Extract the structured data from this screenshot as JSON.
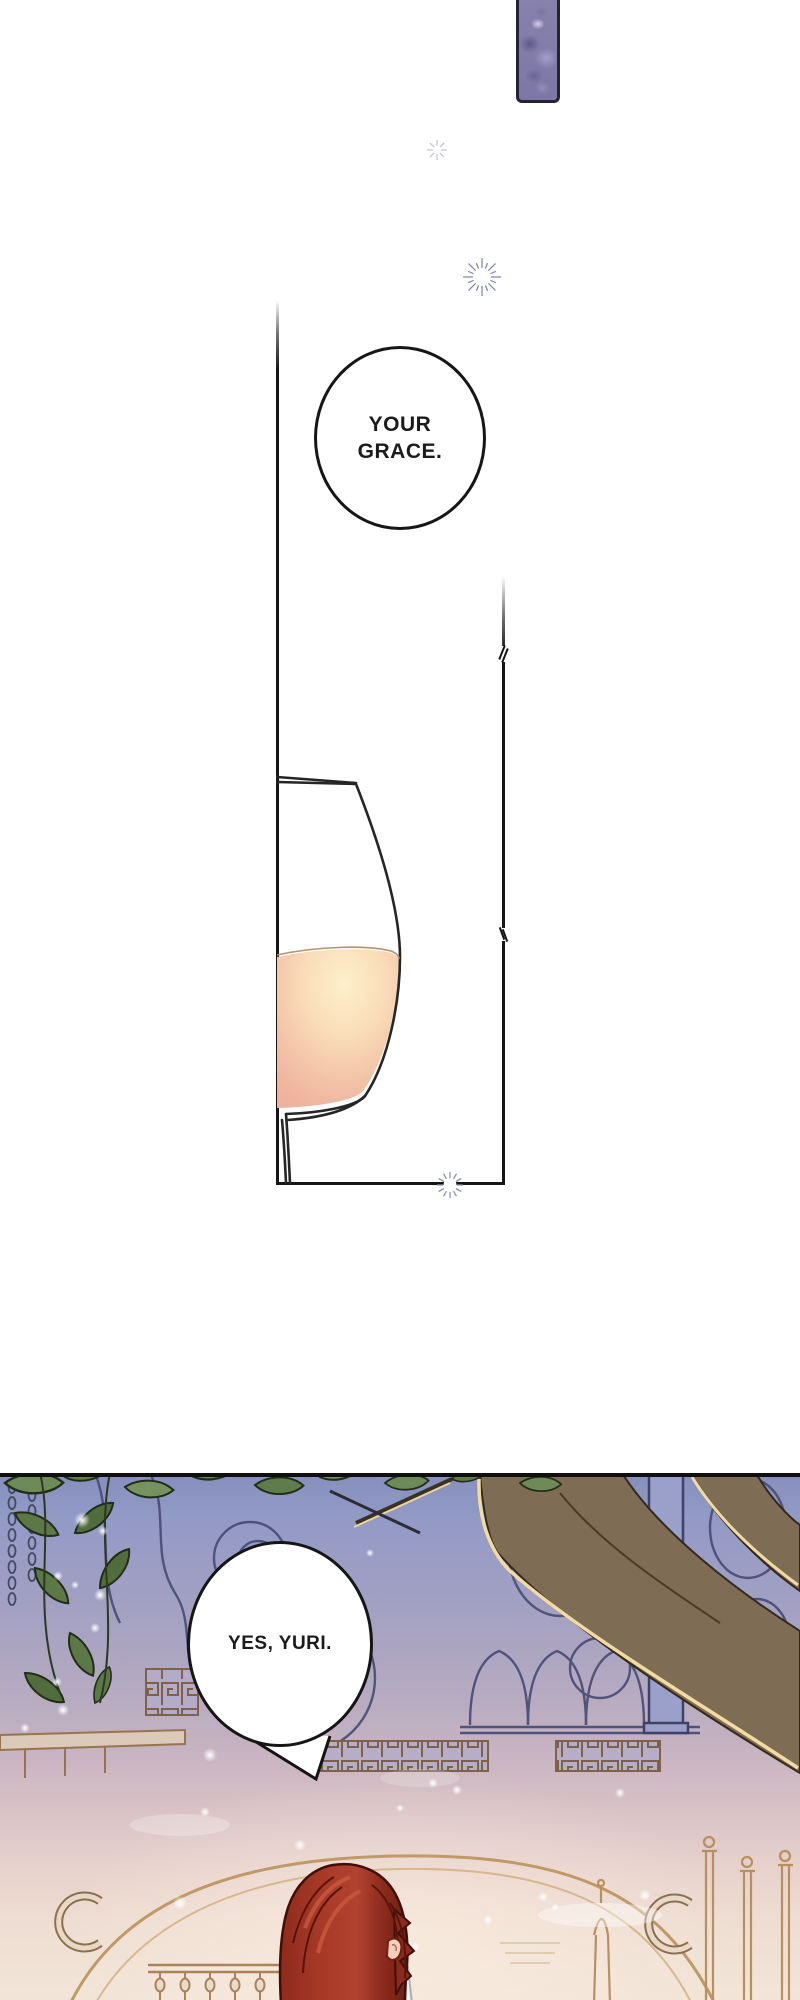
{
  "page": {
    "width_px": 800,
    "height_px": 2000,
    "background": "#ffffff",
    "kind": "webtoon comic page"
  },
  "dialogue": {
    "bubble1": "YOUR GRACE.",
    "bubble2": "YES, YURI."
  },
  "icons": {
    "sparkle_small": "sparkle-icon",
    "starburst_ring": "starburst-icon",
    "border_sparkle": "border-sparkle-icon"
  },
  "colors": {
    "ink": "#161616",
    "panel_border": "#151515",
    "thumb_border": "#262338",
    "thumb_purple": "#8781ad",
    "wine_highlight": "#fdf0ca",
    "wine_mid": "#f3c3a8",
    "wine_edge": "#eeb29d",
    "scene_sky_top": "#878fbc",
    "scene_mauve": "#c3b1c1",
    "scene_cream": "#f2e5d8",
    "tracery_indigo": "#474a72",
    "brass_line": "#b8905f",
    "leaf_green": "#6d8a58",
    "leaf_dark": "#55713f",
    "branch_brown": "#7e6c54",
    "branch_gold_edge": "#f1dba3",
    "hair_red": "#aa3a28",
    "hair_shadow": "#6f1f13",
    "skin": "#f4d0ba",
    "sparkle_indigo": "#8e93bb"
  }
}
